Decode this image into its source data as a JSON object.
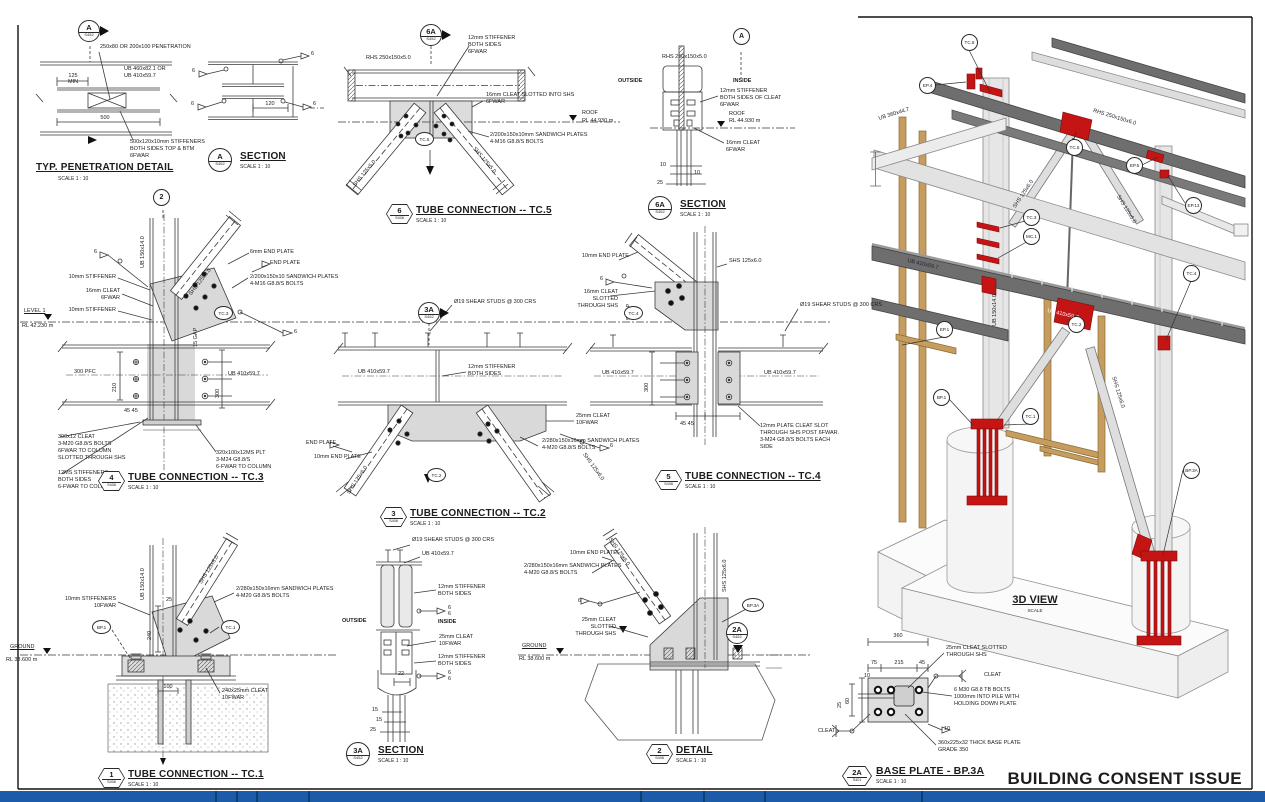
{
  "banner": "BUILDING CONSENT ISSUE",
  "misc": {
    "weld": "6"
  },
  "pen": {
    "num": "A",
    "sheet": "S452",
    "title": "TYP. PENETRATION DETAIL",
    "scale": "SCALE 1 : 10",
    "note_pen": "250x80 OR 200x100 PENETRATION",
    "note_beam": "UB 460x82.1 OR\nUB 410x59.7",
    "d125": "125",
    "dmin": "MIN",
    "d500": "500",
    "note_stiff": "500x120x10mm STIFFENERS\nBOTH SIDES TOP & BTM\n6FWAR"
  },
  "seca": {
    "num": "A",
    "sheet": "S452",
    "title": "SECTION",
    "scale": "SCALE 1 : 10",
    "d120": "120"
  },
  "tc5": {
    "cut_num": "6A",
    "cut_sheet": "S452",
    "num": "6",
    "sheet": "S406",
    "title": "TUBE CONNECTION -- TC.5",
    "scale": "SCALE 1 : 10",
    "rhs": "RHS 250x150x5.0",
    "stiff": "12mm STIFFENER\nBOTH SIDES\n6FWAR",
    "cleat": "16mm CLEAT SLOTTED INTO SHS\n6FWAR",
    "roof": "ROOF",
    "roof_rl": "RL 44.930 m",
    "sandwich": "2/200x150x10mm SANDWICH PLATES\n4-M16 G8.8/S BOLTS",
    "brace_l": "SHS 125x5.0",
    "brace_r": "SHS 125x5.0",
    "tag": "TC.5"
  },
  "sec6a": {
    "num": "6A",
    "sheet": "S452",
    "title": "SECTION",
    "scale": "SCALE 1 : 10",
    "cut": "A",
    "rhs": "RHS 250x150x5.0",
    "outside": "OUTSIDE",
    "inside": "INSIDE",
    "stiff": "12mm STIFFENER\nBOTH SIDES OF CLEAT\n6FWAR",
    "roof": "ROOF",
    "roof_rl": "RL 44.930 m",
    "cleat": "16mm CLEAT\n6FWAR",
    "d10a": "10",
    "d10b": "10",
    "d25": "25"
  },
  "tc3": {
    "cut": "2",
    "num": "4",
    "sheet": "S406",
    "title": "TUBE CONNECTION -- TC.3",
    "scale": "SCALE 1 : 10",
    "col": "UB 150x14.0",
    "brace": "SHS 125x6.0",
    "ep6": "6mm END PLATE",
    "ep": "END PLATE",
    "stiff_a": "10mm STIFFENER",
    "cleat": "16mm CLEAT\n6FWAR",
    "stiff_b": "10mm STIFFENER",
    "sandwich": "2/200x150x10 SANDWICH PLATES\n4-M16 G8.8/S BOLTS",
    "tag": "TC.3",
    "level": "LEVEL 1",
    "level_rl": "RL 42.230 m",
    "pfc": "300 PFC",
    "ub": "UB 410x59.7",
    "cleat300": "300x12 CLEAT\n3-M20 G8.8/S BOLTS\n6FWAR TO COLUMN\nSLOTTED THROUGH SHS",
    "stiff12": "12MS STIFFENERS\nBOTH SIDES\n6-FWAR TO COLUMN",
    "plt": "320x100x12MS PLT\n3-M24 G8.8/S\n6-FWAR TO COLUMN",
    "d210": "210",
    "d300": "300",
    "d45": "45  45",
    "gap": "15 GAP"
  },
  "tc2": {
    "cut_num": "3A",
    "cut_sheet": "S452",
    "num": "3",
    "sheet": "S406",
    "title": "TUBE CONNECTION -- TC.2",
    "scale": "SCALE 1 : 10",
    "studs": "Ø19 SHEAR STUDS @ 300 CRS",
    "ub": "UB 410x59.7",
    "stiff": "12mm STIFFENER\nBOTH SIDES",
    "cleat": "25mm CLEAT\n10FWAR",
    "sandwich": "2/280x150x16mm SANDWICH PLATES\n4-M20 G8.8/S BOLTS",
    "ep": "END PLATE",
    "ep10": "10mm END PLATE",
    "brace_l": "SHS 125x6.0",
    "brace_r": "SHS 125x6.0",
    "tag": "TC.2"
  },
  "tc4": {
    "num": "5",
    "sheet": "S406",
    "title": "TUBE CONNECTION -- TC.4",
    "scale": "SCALE 1 : 10",
    "ep10": "10mm END PLATE",
    "shs": "SHS 125x6.0",
    "cleat": "16mm CLEAT SLOTTED\nTHROUGH SHS",
    "tag": "TC.4",
    "gap": "5 GAP",
    "studs": "Ø19 SHEAR STUDS @ 300 CRS",
    "ub_l": "UB 410x59.7",
    "ub_r": "UB 410x59.7",
    "plate": "12mm PLATE CLEAT SLOT\nTHROUGH SHS POST 6FWAR.\n3-M24 G8.8/S BOLTS EACH\nSIDE",
    "d300": "300",
    "d45": "45  45"
  },
  "tc1": {
    "num": "1",
    "sheet": "S406",
    "title": "TUBE CONNECTION -- TC.1",
    "scale": "SCALE 1 : 10",
    "col": "UB 150x14.0",
    "brace": "SHS 125x6.0",
    "stiff": "10mm STIFFENERS\n10FWAR",
    "sandwich": "2/280x150x16mm SANDWICH PLATES\n4-M20 G8.8/S BOLTS",
    "bp_tag": "BP.1",
    "tag": "TC.1",
    "ground": "GROUND",
    "ground_rl": "RL 38.600 m",
    "cleat": "240x25mm CLEAT\n10FWAR",
    "d25": "25",
    "d240": "240",
    "d100": "100"
  },
  "sec3a": {
    "num": "3A",
    "sheet": "S452",
    "title": "SECTION",
    "scale": "SCALE 1 : 10",
    "studs": "Ø19 SHEAR STUDS @ 300 CRS",
    "ub": "UB 410x59.7",
    "stiff_a": "12mm STIFFENER\nBOTH SIDES",
    "cleat": "25mm CLEAT\n10FWAR",
    "stiff_b": "12mm STIFFENER\nBOTH SIDES",
    "outside": "OUTSIDE",
    "inside": "INSIDE",
    "d22": "22",
    "d15a": "15",
    "d15b": "15",
    "d25": "25"
  },
  "det2": {
    "num": "2",
    "sheet": "S406",
    "title": "DETAIL",
    "scale": "SCALE 1 : 10",
    "cut_num": "2A",
    "cut_sheet": "S452",
    "ep10": "10mm END PLATE",
    "sandwich": "2/280x150x16mm SANDWICH PLATES\n4-M20 G8.8/S BOLTS",
    "cleat": "25mm CLEAT SLOTTED\nTHROUGH SHS",
    "ground": "GROUND",
    "ground_rl": "RL 38.600 m",
    "brace": "SHS 125x6.0",
    "col": "SHS 125x6.0",
    "bp_tag": "BP.3A"
  },
  "bp3a": {
    "num": "2A",
    "sheet": "S401",
    "title": "BASE PLATE - BP.3A",
    "scale": "SCALE 1 : 10",
    "d360": "360",
    "d75": "75",
    "d215": "215",
    "d45": "45",
    "d10": "10",
    "d10b": "10",
    "d60": "60",
    "d25": "25",
    "cleat_note": "25mm CLEAT SLOTTED\nTHROUGH SHS",
    "cleat_r": "CLEAT",
    "cleat_l": "CLEAT",
    "bolts": "6 M30 G8.8 TB BOLTS\n1000mm INTO PILE WITH\nHOLDING DOWN PLATE",
    "plate": "360x225x32 THICK BASE PLATE\nGRADE 350"
  },
  "v3d": {
    "title": "3D VIEW",
    "scale": "SCALE",
    "tags": {
      "tc6": "TC.6",
      "ep4": "EP.4",
      "tc5": "TC.5",
      "ep5": "EP.5",
      "ep13": "EP.13",
      "tc3": "TC.3",
      "mc1": "MC.1",
      "tc4": "TC.4",
      "ep1": "EP.1",
      "tc2": "TC.2",
      "bp1": "BP.1",
      "tc1": "TC.1",
      "bp3a": "BP.3A"
    },
    "m": {
      "ub360": "UB 360x44.7",
      "rhs": "RHS 250x150x6.0",
      "shs_a": "SHS 125x6.0",
      "shs_b": "SHS 125x6.0",
      "shs_c": "SHS 125x6.0",
      "ub410_a": "UB 410x59.7",
      "ub410_b": "UB 410x59.7",
      "col": "UB 150x14.0"
    }
  }
}
